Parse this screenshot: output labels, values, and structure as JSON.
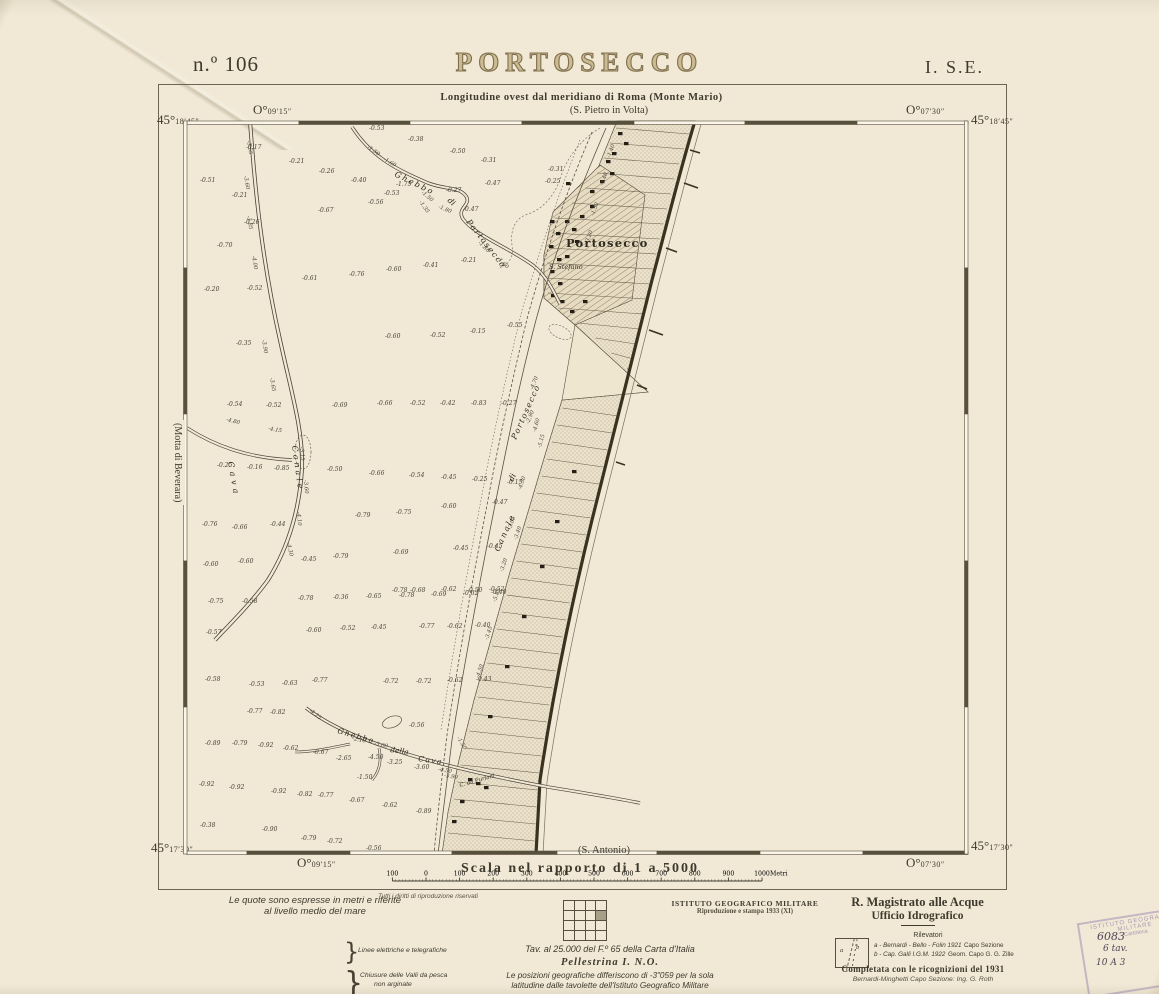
{
  "header": {
    "sheet_no": "n.º 106",
    "title": "PORTOSECCO",
    "index": "I. S.E."
  },
  "frame": {
    "longitude_note": "Longitudine ovest dal meridiano di Roma (Monte Mario)",
    "adjacent_top": "(S. Pietro in Volta)",
    "adjacent_bottom": "(S. Antonio)",
    "adjacent_left": "(Motta di Beverara)",
    "corners": {
      "tl_lat_deg": "45°",
      "tl_lat_min": "18′45″",
      "tl_lon_deg": "O°",
      "tl_lon_min": "09′15″",
      "tr_lon_deg": "O°",
      "tr_lon_min": "07′30″",
      "tr_lat_deg": "45°",
      "tr_lat_min": "18′45″",
      "bl_lat_deg": "45°",
      "bl_lat_min": "17′30″",
      "bl_lon_deg": "O°",
      "bl_lon_min": "09′15″",
      "br_lat_deg": "45°",
      "br_lat_min": "17′30″",
      "br_lon_deg": "O°",
      "br_lon_min": "07′30″"
    }
  },
  "scale": {
    "label": "Scala nel rapporto di 1 a 5000",
    "bar_labels": [
      "100",
      "0",
      "100",
      "200",
      "300",
      "400",
      "500",
      "600",
      "700",
      "800",
      "900",
      "1000"
    ],
    "unit": "Metri"
  },
  "map": {
    "places": [
      {
        "text": "Portosecco",
        "x": 566,
        "y": 247,
        "fs": 11.5,
        "bold": true,
        "sp": 1.2
      },
      {
        "text": "S. Stefano",
        "x": 549,
        "y": 269,
        "fs": 6.5,
        "it": true
      },
      {
        "text": "C. da Furlani",
        "x": 460,
        "y": 787,
        "fs": 5.5,
        "it": true,
        "r": -16
      },
      {
        "text": "Ghebbo",
        "x": 394,
        "y": 176,
        "fs": 8,
        "it": true,
        "r": 26,
        "sp": 2
      },
      {
        "text": "di",
        "x": 447,
        "y": 201,
        "fs": 8,
        "it": true,
        "r": 42
      },
      {
        "text": "Portosecco",
        "x": 466,
        "y": 222,
        "fs": 8,
        "it": true,
        "r": 52,
        "sp": 1.5
      },
      {
        "text": "Cava",
        "x": 228,
        "y": 462,
        "fs": 8,
        "it": true,
        "r": 80,
        "sp": 4
      },
      {
        "text": "Canale",
        "x": 292,
        "y": 446,
        "fs": 8,
        "it": true,
        "r": 82,
        "sp": 3
      },
      {
        "text": "Canale",
        "x": 499,
        "y": 552,
        "fs": 8,
        "it": true,
        "r": -66,
        "sp": 2
      },
      {
        "text": "di",
        "x": 513,
        "y": 482,
        "fs": 8,
        "it": true,
        "r": -66
      },
      {
        "text": "Portosecco",
        "x": 516,
        "y": 440,
        "fs": 8,
        "it": true,
        "r": -66,
        "sp": 1.5
      },
      {
        "text": "Ghebbo",
        "x": 337,
        "y": 733,
        "fs": 7.5,
        "it": true,
        "r": 16,
        "sp": 1.5
      },
      {
        "text": "della",
        "x": 390,
        "y": 752,
        "fs": 7.5,
        "it": true,
        "r": 8
      },
      {
        "text": "Cava",
        "x": 418,
        "y": 761,
        "fs": 7.5,
        "it": true,
        "r": 8,
        "sp": 1.5
      }
    ],
    "soundings": [
      {
        "x": 369,
        "y": 130,
        "v": "-0.53"
      },
      {
        "x": 408,
        "y": 141,
        "v": "-0.38"
      },
      {
        "x": 246,
        "y": 149,
        "v": "-0.17"
      },
      {
        "x": 289,
        "y": 163,
        "v": "-0.21"
      },
      {
        "x": 450,
        "y": 153,
        "v": "-0.50"
      },
      {
        "x": 481,
        "y": 162,
        "v": "-0.31"
      },
      {
        "x": 319,
        "y": 173,
        "v": "-0.26"
      },
      {
        "x": 351,
        "y": 182,
        "v": "-0.40"
      },
      {
        "x": 396,
        "y": 186,
        "v": "-1.75"
      },
      {
        "x": 384,
        "y": 195,
        "v": "-0.53"
      },
      {
        "x": 446,
        "y": 192,
        "v": "-0.27"
      },
      {
        "x": 368,
        "y": 204,
        "v": "-0.56"
      },
      {
        "x": 485,
        "y": 185,
        "v": "-0.47"
      },
      {
        "x": 318,
        "y": 212,
        "v": "-0.67"
      },
      {
        "x": 232,
        "y": 197,
        "v": "-0.21"
      },
      {
        "x": 200,
        "y": 182,
        "v": "-0.51"
      },
      {
        "x": 244,
        "y": 224,
        "v": "-0.26"
      },
      {
        "x": 217,
        "y": 247,
        "v": "-0.70"
      },
      {
        "x": 463,
        "y": 211,
        "v": "-0.47"
      },
      {
        "x": 461,
        "y": 262,
        "v": "-0.21"
      },
      {
        "x": 423,
        "y": 267,
        "v": "-0.41"
      },
      {
        "x": 386,
        "y": 271,
        "v": "-0.60"
      },
      {
        "x": 349,
        "y": 276,
        "v": "-0.76"
      },
      {
        "x": 302,
        "y": 280,
        "v": "-0.61"
      },
      {
        "x": 204,
        "y": 291,
        "v": "-0.20"
      },
      {
        "x": 247,
        "y": 290,
        "v": "-0.52"
      },
      {
        "x": 548,
        "y": 171,
        "v": "-0.31"
      },
      {
        "x": 545,
        "y": 183,
        "v": "-0.25"
      },
      {
        "x": 236,
        "y": 345,
        "v": "-0.35"
      },
      {
        "x": 385,
        "y": 338,
        "v": "-0.60"
      },
      {
        "x": 430,
        "y": 337,
        "v": "-0.52"
      },
      {
        "x": 470,
        "y": 333,
        "v": "-0.15"
      },
      {
        "x": 507,
        "y": 327,
        "v": "-0.55"
      },
      {
        "x": 227,
        "y": 406,
        "v": "-0.54"
      },
      {
        "x": 266,
        "y": 407,
        "v": "-0.52"
      },
      {
        "x": 332,
        "y": 407,
        "v": "-0.69"
      },
      {
        "x": 377,
        "y": 405,
        "v": "-0.66"
      },
      {
        "x": 410,
        "y": 405,
        "v": "-0.52"
      },
      {
        "x": 440,
        "y": 405,
        "v": "-0.42"
      },
      {
        "x": 471,
        "y": 405,
        "v": "-0.83"
      },
      {
        "x": 501,
        "y": 405,
        "v": "-0.27"
      },
      {
        "x": 217,
        "y": 467,
        "v": "-0.25"
      },
      {
        "x": 247,
        "y": 469,
        "v": "-0.16"
      },
      {
        "x": 274,
        "y": 470,
        "v": "-0.85"
      },
      {
        "x": 327,
        "y": 471,
        "v": "-0.50"
      },
      {
        "x": 369,
        "y": 475,
        "v": "-0.66"
      },
      {
        "x": 409,
        "y": 477,
        "v": "-0.54"
      },
      {
        "x": 441,
        "y": 479,
        "v": "-0.45"
      },
      {
        "x": 472,
        "y": 481,
        "v": "-0.25"
      },
      {
        "x": 507,
        "y": 484,
        "v": "-0.15"
      },
      {
        "x": 492,
        "y": 504,
        "v": "-0.47"
      },
      {
        "x": 441,
        "y": 508,
        "v": "-0.60"
      },
      {
        "x": 396,
        "y": 514,
        "v": "-0.75"
      },
      {
        "x": 355,
        "y": 517,
        "v": "-0.79"
      },
      {
        "x": 202,
        "y": 526,
        "v": "-0.76"
      },
      {
        "x": 232,
        "y": 529,
        "v": "-0.66"
      },
      {
        "x": 270,
        "y": 526,
        "v": "-0.44"
      },
      {
        "x": 203,
        "y": 566,
        "v": "-0.60"
      },
      {
        "x": 238,
        "y": 563,
        "v": "-0.60"
      },
      {
        "x": 301,
        "y": 561,
        "v": "-0.45"
      },
      {
        "x": 333,
        "y": 558,
        "v": "-0.79"
      },
      {
        "x": 393,
        "y": 554,
        "v": "-0.69"
      },
      {
        "x": 453,
        "y": 550,
        "v": "-0.45"
      },
      {
        "x": 487,
        "y": 548,
        "v": "-0.45"
      },
      {
        "x": 392,
        "y": 592,
        "v": "-0.78"
      },
      {
        "x": 410,
        "y": 592,
        "v": "-0.68"
      },
      {
        "x": 441,
        "y": 591,
        "v": "-0.62"
      },
      {
        "x": 467,
        "y": 592,
        "v": "-0.50"
      },
      {
        "x": 489,
        "y": 591,
        "v": "-0.52"
      },
      {
        "x": 208,
        "y": 603,
        "v": "-0.75"
      },
      {
        "x": 242,
        "y": 603,
        "v": "-0.58"
      },
      {
        "x": 298,
        "y": 600,
        "v": "-0.78"
      },
      {
        "x": 333,
        "y": 599,
        "v": "-0.36"
      },
      {
        "x": 366,
        "y": 598,
        "v": "-0.65"
      },
      {
        "x": 399,
        "y": 597,
        "v": "-0.78"
      },
      {
        "x": 431,
        "y": 596,
        "v": "-0.69"
      },
      {
        "x": 463,
        "y": 595,
        "v": "-0.62"
      },
      {
        "x": 491,
        "y": 594,
        "v": "-0.40"
      },
      {
        "x": 206,
        "y": 634,
        "v": "-0.57"
      },
      {
        "x": 306,
        "y": 632,
        "v": "-0.60"
      },
      {
        "x": 340,
        "y": 630,
        "v": "-0.52"
      },
      {
        "x": 371,
        "y": 629,
        "v": "-0.45"
      },
      {
        "x": 419,
        "y": 628,
        "v": "-0.77"
      },
      {
        "x": 447,
        "y": 628,
        "v": "-0.62"
      },
      {
        "x": 475,
        "y": 627,
        "v": "-0.40"
      },
      {
        "x": 205,
        "y": 681,
        "v": "-0.58"
      },
      {
        "x": 249,
        "y": 686,
        "v": "-0.53"
      },
      {
        "x": 282,
        "y": 685,
        "v": "-0.63"
      },
      {
        "x": 312,
        "y": 682,
        "v": "-0.77"
      },
      {
        "x": 383,
        "y": 683,
        "v": "-0.72"
      },
      {
        "x": 416,
        "y": 683,
        "v": "-0.72"
      },
      {
        "x": 447,
        "y": 682,
        "v": "-0.62"
      },
      {
        "x": 476,
        "y": 681,
        "v": "-0.43"
      },
      {
        "x": 247,
        "y": 713,
        "v": "-0.77"
      },
      {
        "x": 270,
        "y": 714,
        "v": "-0.82"
      },
      {
        "x": 409,
        "y": 727,
        "v": "-0.56"
      },
      {
        "x": 205,
        "y": 745,
        "v": "-0.89"
      },
      {
        "x": 232,
        "y": 745,
        "v": "-0.79"
      },
      {
        "x": 258,
        "y": 747,
        "v": "-0.92"
      },
      {
        "x": 283,
        "y": 750,
        "v": "-0.62"
      },
      {
        "x": 313,
        "y": 754,
        "v": "-0.67"
      },
      {
        "x": 336,
        "y": 760,
        "v": "-2.65"
      },
      {
        "x": 368,
        "y": 759,
        "v": "-4.50"
      },
      {
        "x": 387,
        "y": 764,
        "v": "-3.25"
      },
      {
        "x": 414,
        "y": 769,
        "v": "-3.60"
      },
      {
        "x": 357,
        "y": 779,
        "v": "-1.50"
      },
      {
        "x": 199,
        "y": 786,
        "v": "-0.92"
      },
      {
        "x": 229,
        "y": 789,
        "v": "-0.92"
      },
      {
        "x": 271,
        "y": 793,
        "v": "-0.92"
      },
      {
        "x": 297,
        "y": 796,
        "v": "-0.82"
      },
      {
        "x": 318,
        "y": 797,
        "v": "-0.77"
      },
      {
        "x": 349,
        "y": 802,
        "v": "-0.67"
      },
      {
        "x": 382,
        "y": 807,
        "v": "-0.62"
      },
      {
        "x": 416,
        "y": 813,
        "v": "-0.89"
      },
      {
        "x": 262,
        "y": 831,
        "v": "-0.90"
      },
      {
        "x": 200,
        "y": 827,
        "v": "-0.38"
      },
      {
        "x": 301,
        "y": 840,
        "v": "-0.79"
      },
      {
        "x": 327,
        "y": 843,
        "v": "-0.72"
      },
      {
        "x": 366,
        "y": 850,
        "v": "-0.56"
      }
    ],
    "channel_depths": [
      {
        "x": 247,
        "y": 141,
        "v": "-3.55",
        "r": 80
      },
      {
        "x": 244,
        "y": 176,
        "v": "-3.60",
        "r": 80
      },
      {
        "x": 247,
        "y": 216,
        "v": "-3.85",
        "r": 80
      },
      {
        "x": 252,
        "y": 256,
        "v": "-4.00",
        "r": 80
      },
      {
        "x": 262,
        "y": 340,
        "v": "-3.90",
        "r": 80
      },
      {
        "x": 270,
        "y": 378,
        "v": "-3.65",
        "r": 80
      },
      {
        "x": 300,
        "y": 447,
        "v": "-3.15",
        "r": 85
      },
      {
        "x": 304,
        "y": 480,
        "v": "-3.60",
        "r": 85
      },
      {
        "x": 297,
        "y": 512,
        "v": "-4.10",
        "r": 85
      },
      {
        "x": 287,
        "y": 543,
        "v": "-4.30",
        "r": 78
      },
      {
        "x": 226,
        "y": 421,
        "v": "-4.80",
        "r": 14
      },
      {
        "x": 268,
        "y": 430,
        "v": "-4.15",
        "r": 10
      },
      {
        "x": 367,
        "y": 148,
        "v": "-1.50",
        "r": 35
      },
      {
        "x": 383,
        "y": 160,
        "v": "-1.60",
        "r": 30
      },
      {
        "x": 421,
        "y": 193,
        "v": "-1.50",
        "r": 40
      },
      {
        "x": 419,
        "y": 202,
        "v": "-1.35",
        "r": 55
      },
      {
        "x": 438,
        "y": 208,
        "v": "-1.80",
        "r": 22
      },
      {
        "x": 478,
        "y": 243,
        "v": "-1.80",
        "r": 45
      },
      {
        "x": 497,
        "y": 259,
        "v": "-1.60",
        "r": 45
      },
      {
        "x": 610,
        "y": 158,
        "v": "-1.40",
        "r": -70
      },
      {
        "x": 603,
        "y": 186,
        "v": "-4.40",
        "r": -70
      },
      {
        "x": 594,
        "y": 216,
        "v": "-1.50",
        "r": -70
      },
      {
        "x": 588,
        "y": 244,
        "v": "-3.20",
        "r": -70
      },
      {
        "x": 533,
        "y": 390,
        "v": "-4.70",
        "r": -68
      },
      {
        "x": 529,
        "y": 424,
        "v": "-2.90",
        "r": -68
      },
      {
        "x": 536,
        "y": 432,
        "v": "-4.60",
        "r": -75
      },
      {
        "x": 541,
        "y": 448,
        "v": "-5.15",
        "r": -75
      },
      {
        "x": 521,
        "y": 490,
        "v": "-4.30",
        "r": -70
      },
      {
        "x": 511,
        "y": 530,
        "v": "-3.05",
        "r": -72
      },
      {
        "x": 517,
        "y": 540,
        "v": "-3.40",
        "r": -72
      },
      {
        "x": 503,
        "y": 572,
        "v": "-3.20",
        "r": -72
      },
      {
        "x": 496,
        "y": 602,
        "v": "-5.85",
        "r": -72
      },
      {
        "x": 488,
        "y": 640,
        "v": "-3.45",
        "r": -72
      },
      {
        "x": 479,
        "y": 678,
        "v": "-4.50",
        "r": -72
      },
      {
        "x": 352,
        "y": 740,
        "v": "-2.10",
        "r": 12
      },
      {
        "x": 374,
        "y": 745,
        "v": "-3.00",
        "r": 12
      },
      {
        "x": 309,
        "y": 711,
        "v": "-4.25",
        "r": 40
      },
      {
        "x": 438,
        "y": 771,
        "v": "-4.50",
        "r": 8
      },
      {
        "x": 444,
        "y": 777,
        "v": "-3.90",
        "r": 8
      },
      {
        "x": 457,
        "y": 738,
        "v": "-1.50",
        "r": 60
      }
    ]
  },
  "legend": {
    "heading1": "Le quote sono espresse in metri e riferite",
    "heading2": "al livello medio del mare",
    "items": [
      {
        "symbol": "cippi",
        "prefix": "• (29.)",
        "label": "Cippi di Conterminazione Lagunare"
      },
      {
        "symbol": "dash",
        "prefix": "",
        "label": "Canali segnalati"
      },
      {
        "symbol": "dashdot",
        "prefix": "",
        "label": "su pali"
      },
      {
        "symbol": "dots",
        "prefix": "",
        "label": "su tralicci"
      },
      {
        "symbol": "band",
        "prefix": "",
        "label": "Chiaviche"
      },
      {
        "symbol": "band2",
        "prefix": "",
        "label": "arelle"
      },
      {
        "symbol": "dash",
        "prefix": "",
        "label": "rete metallica"
      },
      {
        "symbol": "dashdot",
        "prefix": "",
        "label": "pali"
      }
    ],
    "group1": "Linee elettriche e telegrafiche",
    "group2a": "Chiusure delle Valli da pesca",
    "group2b": "non arginate"
  },
  "footer": {
    "rights": "Tutti i diritti di riproduzione riservati",
    "tav_line": "Tav. al 25.000 del F.º 65 della Carta d'Italia",
    "sheet_name": "Pellestrina I. N.O.",
    "geo_note1": "Le posizioni geografiche differiscono di -3\"059 per la sola",
    "geo_note2": "latitudine dalle tavolette dell'Istituto Geografico Militare",
    "igm1": "ISTITUTO GEOGRAFICO MILITARE",
    "igm2": "Riproduzione e stampa 1933 (XI)",
    "agency1": "R. Magistrato alle Acque",
    "agency2": "Ufficio Idrografico",
    "rilevatori": "Rilevatori",
    "box_a": "a",
    "box_b": "b",
    "survey_a": "a - Bernardi - Bello - Folin 1921",
    "survey_a_role": "Capo Sezione",
    "survey_b": "b - Cap. Galli I.G.M.   1922",
    "survey_b_role": "Geom. Capo G. G. Zille",
    "completata": "Completata con le ricognizioni del 1931",
    "firma": "Bernardi-Minghetti   Capo Sezione: Ing. G. Roth"
  },
  "stamp": {
    "line1": "ISTITUTO GEOGRAFICO",
    "line2": "MILITARE",
    "line3": "Cartoteca",
    "hand1": "6083",
    "hand2": "6 tav.",
    "hand3": "10 A 3"
  },
  "colors": {
    "paper": "#f1e9d6",
    "ink": "#3f3a2e",
    "title_brown": "#7f6f4d",
    "stamp_violet": "#9276aa"
  }
}
